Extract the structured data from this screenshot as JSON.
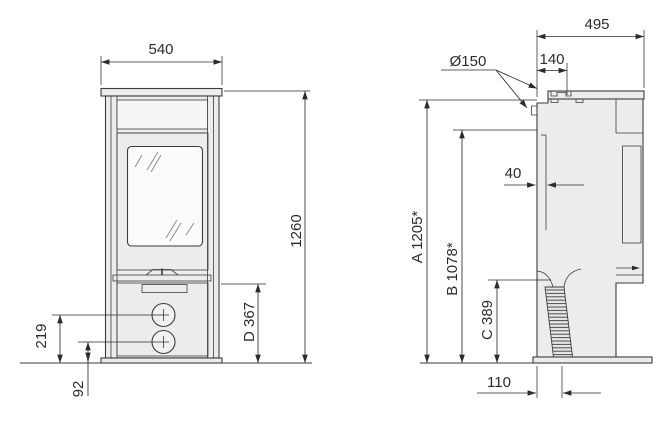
{
  "colors": {
    "background": "#ffffff",
    "line": "#3c3c3c",
    "dim": "#2c2c2c",
    "body_fill": "#ececec",
    "glass_fill": "#fbfbfb"
  },
  "front_view": {
    "dim_width": "540",
    "dim_height": "1260",
    "dim_d": "D 367",
    "dim_upper_control": "219",
    "dim_lower_control": "92"
  },
  "side_view": {
    "dim_depth": "495",
    "dim_flue_diameter": "Ø150",
    "dim_flue_offset": "140",
    "dim_rear_gap": "40",
    "dim_a": "A 1205*",
    "dim_b": "B 1078*",
    "dim_c": "C 389",
    "dim_intake_offset": "110"
  }
}
